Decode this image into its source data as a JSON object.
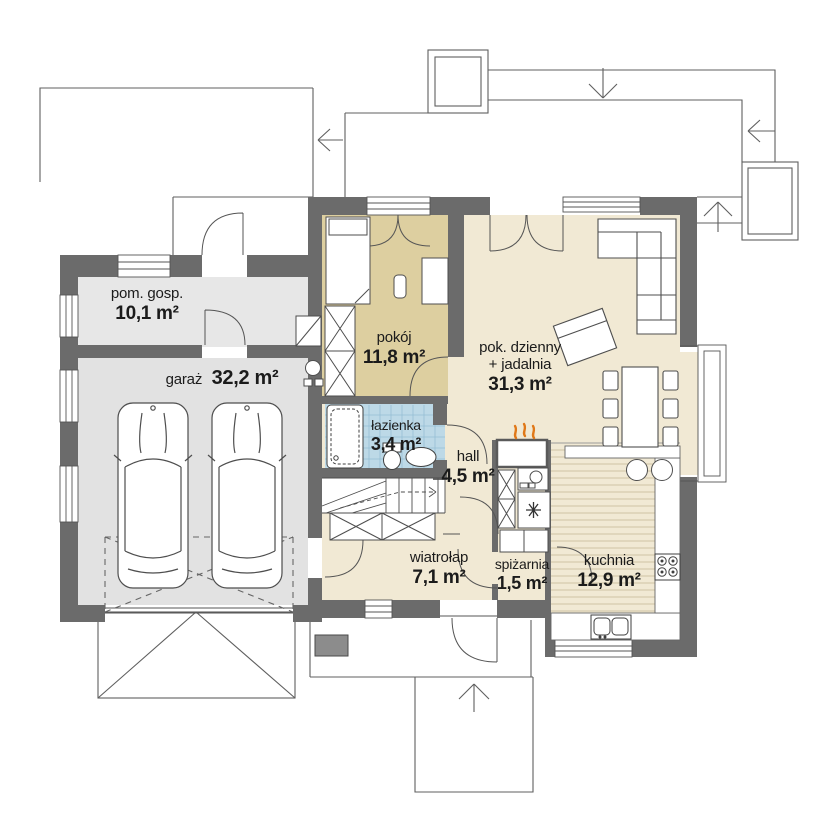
{
  "plan": {
    "type": "house-floor-plan",
    "units": "m²"
  },
  "rooms": [
    {
      "name": "pom. gosp.",
      "area": "10,1 m²"
    },
    {
      "name": "garaż",
      "area": "32,2 m²"
    },
    {
      "name": "pokój",
      "area": "11,8 m²"
    },
    {
      "name": "pok. dzienny",
      "name2": "+ jadalnia",
      "area": "31,3 m²"
    },
    {
      "name": "łazienka",
      "area": "3,4 m²"
    },
    {
      "name": "hall",
      "area": "4,5 m²"
    },
    {
      "name": "wiatrołap",
      "area": "7,1 m²"
    },
    {
      "name": "spiżarnia",
      "area": "1,5 m²"
    },
    {
      "name": "kuchnia",
      "area": "12,9 m²"
    }
  ],
  "colors": {
    "wall": "#6b6b6b",
    "garage_floor": "#e4e4e4",
    "room_floor_tan": "#ddcfa0",
    "living_floor": "#f1e9d4",
    "bath_floor": "#bdd9e7",
    "bath_grid": "#96bed4",
    "kitchen_stripe": "#cfc3a3",
    "flame_accent": "#e07818",
    "line": "#555555"
  }
}
